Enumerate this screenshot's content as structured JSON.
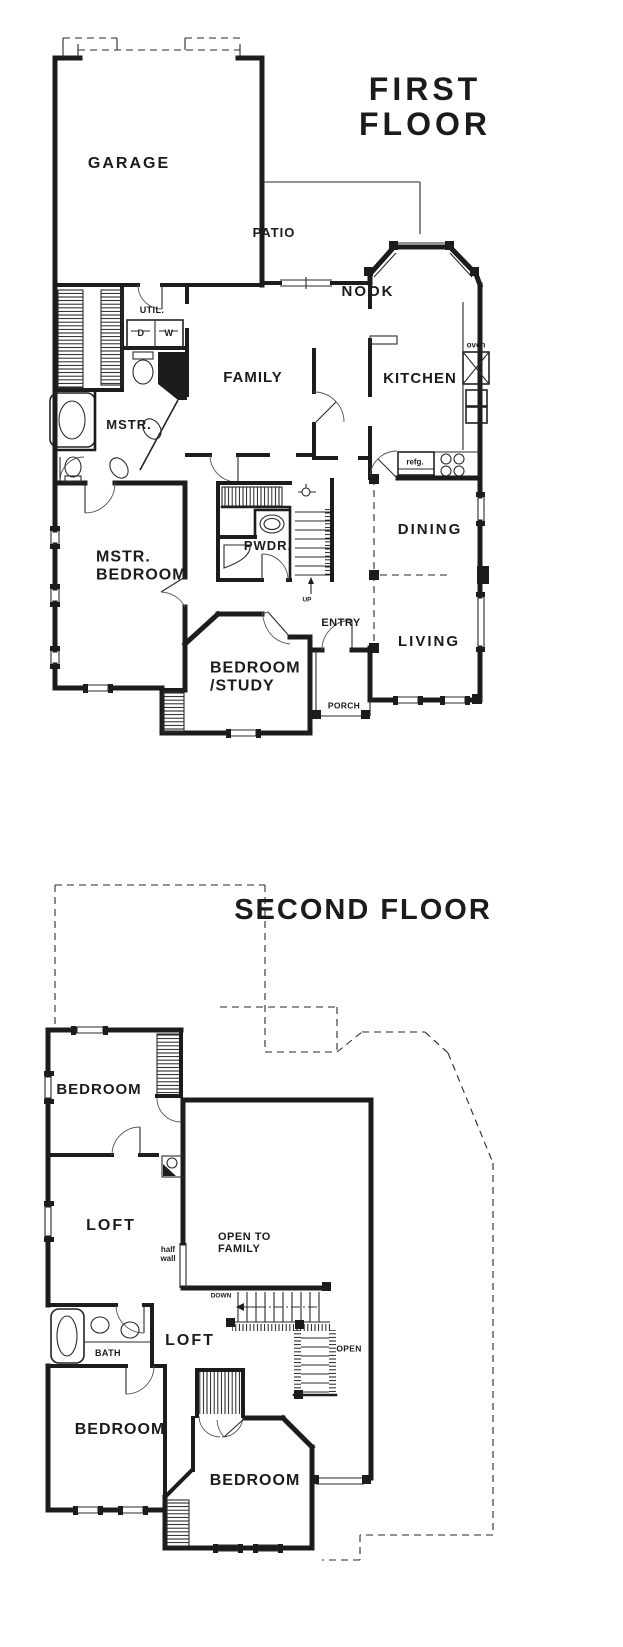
{
  "page": {
    "background": "#ffffff",
    "ink": "#1c1c1c"
  },
  "first_floor": {
    "title": "FIRST FLOOR",
    "rooms": {
      "garage": "GARAGE",
      "patio": "PATIO",
      "nook": "NOOK",
      "kitchen": "KITCHEN",
      "family": "FAMILY",
      "utility": "UTIL.",
      "dryer": "D",
      "washer": "W",
      "master_bath": "MSTR.",
      "master_bedroom": "MSTR.\nBEDROOM",
      "powder": "PWDR.",
      "dining": "DINING",
      "living": "LIVING",
      "bedroom_study": "BEDROOM\n/STUDY",
      "entry": "ENTRY",
      "porch": "PORCH"
    },
    "fixtures": {
      "oven": "oven",
      "refrigerator": "refg.",
      "stairs_up": "UP"
    }
  },
  "second_floor": {
    "title": "SECOND FLOOR",
    "rooms": {
      "bedroom_top": "BEDROOM",
      "loft_upper": "LOFT",
      "open_to_family": "OPEN TO\nFAMILY",
      "loft_lower": "LOFT",
      "bath": "BATH",
      "bedroom_left": "BEDROOM",
      "bedroom_right": "BEDROOM"
    },
    "annotations": {
      "half_wall": "half\nwall",
      "stairs_down": "DOWN",
      "open_to_below": "OPEN"
    }
  },
  "icons": [
    "bathtub-icon",
    "toilet-icon",
    "sink-icon",
    "cooktop-icon",
    "refrigerator-icon",
    "oven-icon",
    "staircase-icon",
    "door-swing-icon",
    "closet-hatch-icon",
    "ceiling-light-icon",
    "window-icon",
    "column-icon"
  ]
}
